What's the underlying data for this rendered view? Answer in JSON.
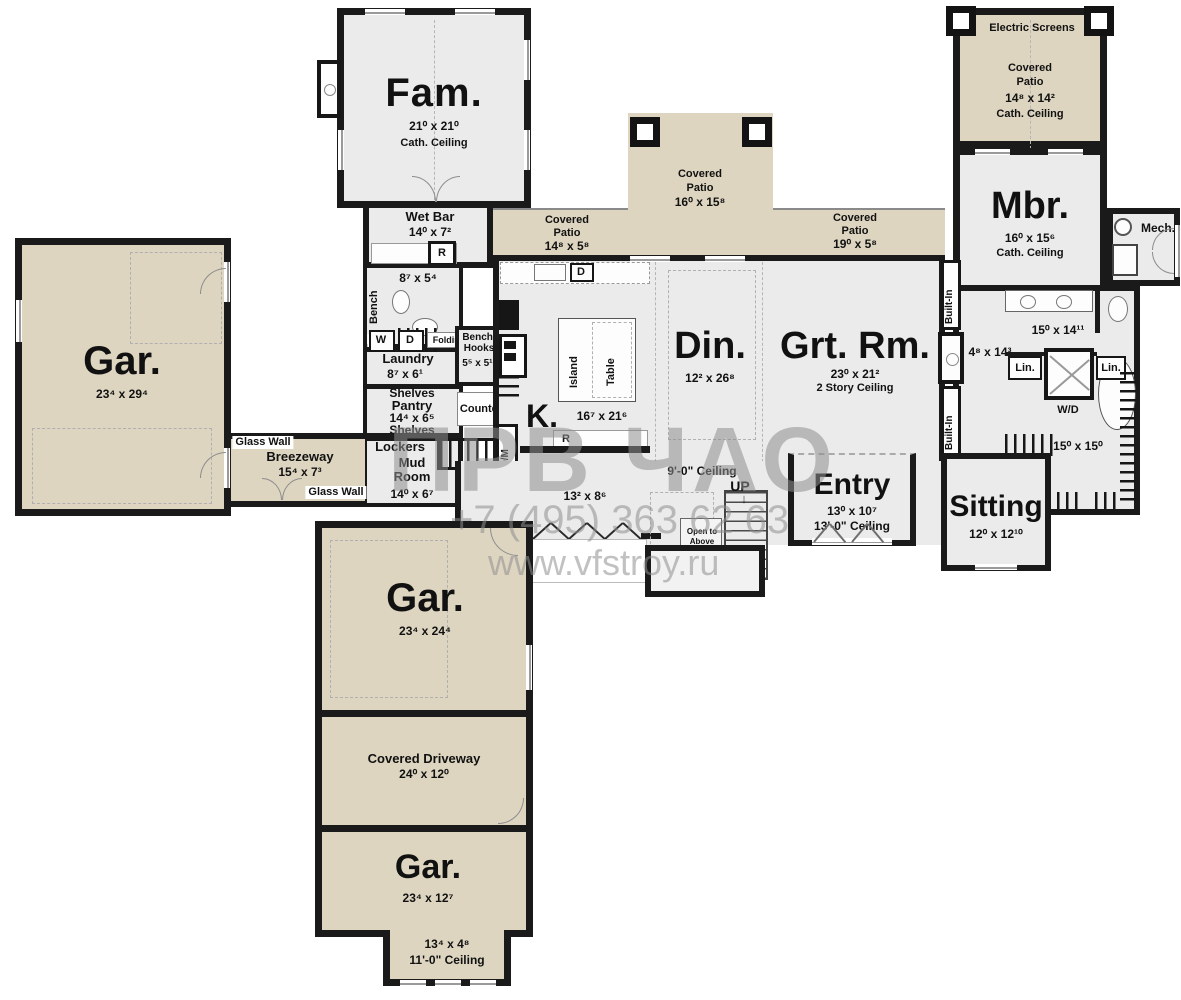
{
  "watermark": {
    "brand": "ПРВ ЧАО",
    "phone": "+7 (495) 363 62 63",
    "site": "www.vfstroy.ru"
  },
  "rooms": {
    "fam": {
      "name": "Fam.",
      "dims": "21⁰ x 21⁰",
      "ceiling": "Cath. Ceiling"
    },
    "wet_bar": {
      "name": "Wet Bar",
      "dims": "14⁰ x 7²",
      "fridge": "R"
    },
    "pool_bath": {
      "bench": "Bench",
      "dims": "8⁷ x 5⁴",
      "linen": "Lin."
    },
    "laundry": {
      "name": "Laundry",
      "dims": "8⁷ x 6¹",
      "washer": "W",
      "dryer": "D",
      "folding": "Folding"
    },
    "bench_hooks": {
      "line1": "Bench/",
      "line2": "Hooks",
      "dims": "5⁵ x 5¹¹"
    },
    "pantry": {
      "name": "Pantry",
      "dims": "14⁴ x 6⁵",
      "shelves_top": "Shelves",
      "shelves_bottom": "Shelves"
    },
    "counter": {
      "name": "Counter"
    },
    "mud_room": {
      "lockers": "Lockers",
      "line1": "Mud",
      "line2": "Room",
      "dims": "14⁰ x 6⁷"
    },
    "kitchen": {
      "name": "K.",
      "dims": "16⁷ x 21⁶",
      "island": "Island",
      "table": "Table",
      "dishwasher": "D",
      "range": "R",
      "oven_micro": "O/M"
    },
    "dining": {
      "name": "Din.",
      "dims": "12² x 26⁸"
    },
    "great_room": {
      "name": "Grt. Rm.",
      "dims": "23⁰ x 21²",
      "ceiling": "2 Story Ceiling"
    },
    "patio_kitchen": {
      "line1": "Covered",
      "line2": "Patio",
      "dims": "14⁸ x 5⁸"
    },
    "patio_center": {
      "line1": "Covered",
      "line2": "Patio",
      "dims": "16⁰ x 15⁸"
    },
    "patio_great": {
      "line1": "Covered",
      "line2": "Patio",
      "dims": "19⁰ x 5⁸"
    },
    "patio_master": {
      "screens": "Electric Screens",
      "line1": "Covered",
      "line2": "Patio",
      "dims": "14⁸ x 14²",
      "ceiling": "Cath. Ceiling"
    },
    "master": {
      "name": "Mbr.",
      "dims": "16⁰ x 15⁶",
      "ceiling": "Cath. Ceiling"
    },
    "mech": {
      "name": "Mech."
    },
    "master_hall": {
      "built_in_1": "Built-In",
      "built_in_2": "Built-In",
      "dims": "4⁸ x 14³"
    },
    "master_bath": {
      "dims": "15⁰ x 14¹¹",
      "linen_left": "Lin.",
      "linen_right": "Lin.",
      "wd": "W/D"
    },
    "master_closet": {
      "dims": "15⁰ x 15⁰"
    },
    "entry": {
      "name": "Entry",
      "dims": "13⁰ x 10⁷",
      "ceiling": "13'-0\" Ceiling"
    },
    "sitting": {
      "name": "Sitting",
      "dims": "12⁰ x 12¹⁰"
    },
    "nook": {
      "dims": "13² x 8⁶",
      "ceiling": "9'-0\" Ceiling"
    },
    "stairs": {
      "up": "UP",
      "open": "Open to Above"
    },
    "garage_left": {
      "name": "Gar.",
      "dims": "23⁴ x 29⁴"
    },
    "breezeway": {
      "name": "Breezeway",
      "dims": "15⁴ x 7³",
      "glass_top": "Glass Wall",
      "glass_bottom": "Glass Wall"
    },
    "garage_middle": {
      "name": "Gar.",
      "dims": "23⁴ x 24⁴"
    },
    "driveway": {
      "name": "Covered Driveway",
      "dims": "24⁰ x 12⁰"
    },
    "garage_bottom": {
      "name": "Gar.",
      "dims": "23⁴ x 12⁷"
    },
    "garage_bump": {
      "dims": "13⁴ x 4⁸",
      "ceiling": "11'-0\" Ceiling"
    }
  },
  "colors": {
    "wall": "#1a1a1a",
    "room_fill": "#ebebeb",
    "patio_fill": "#ddd5c0",
    "watermark": "#8f8f8f"
  }
}
